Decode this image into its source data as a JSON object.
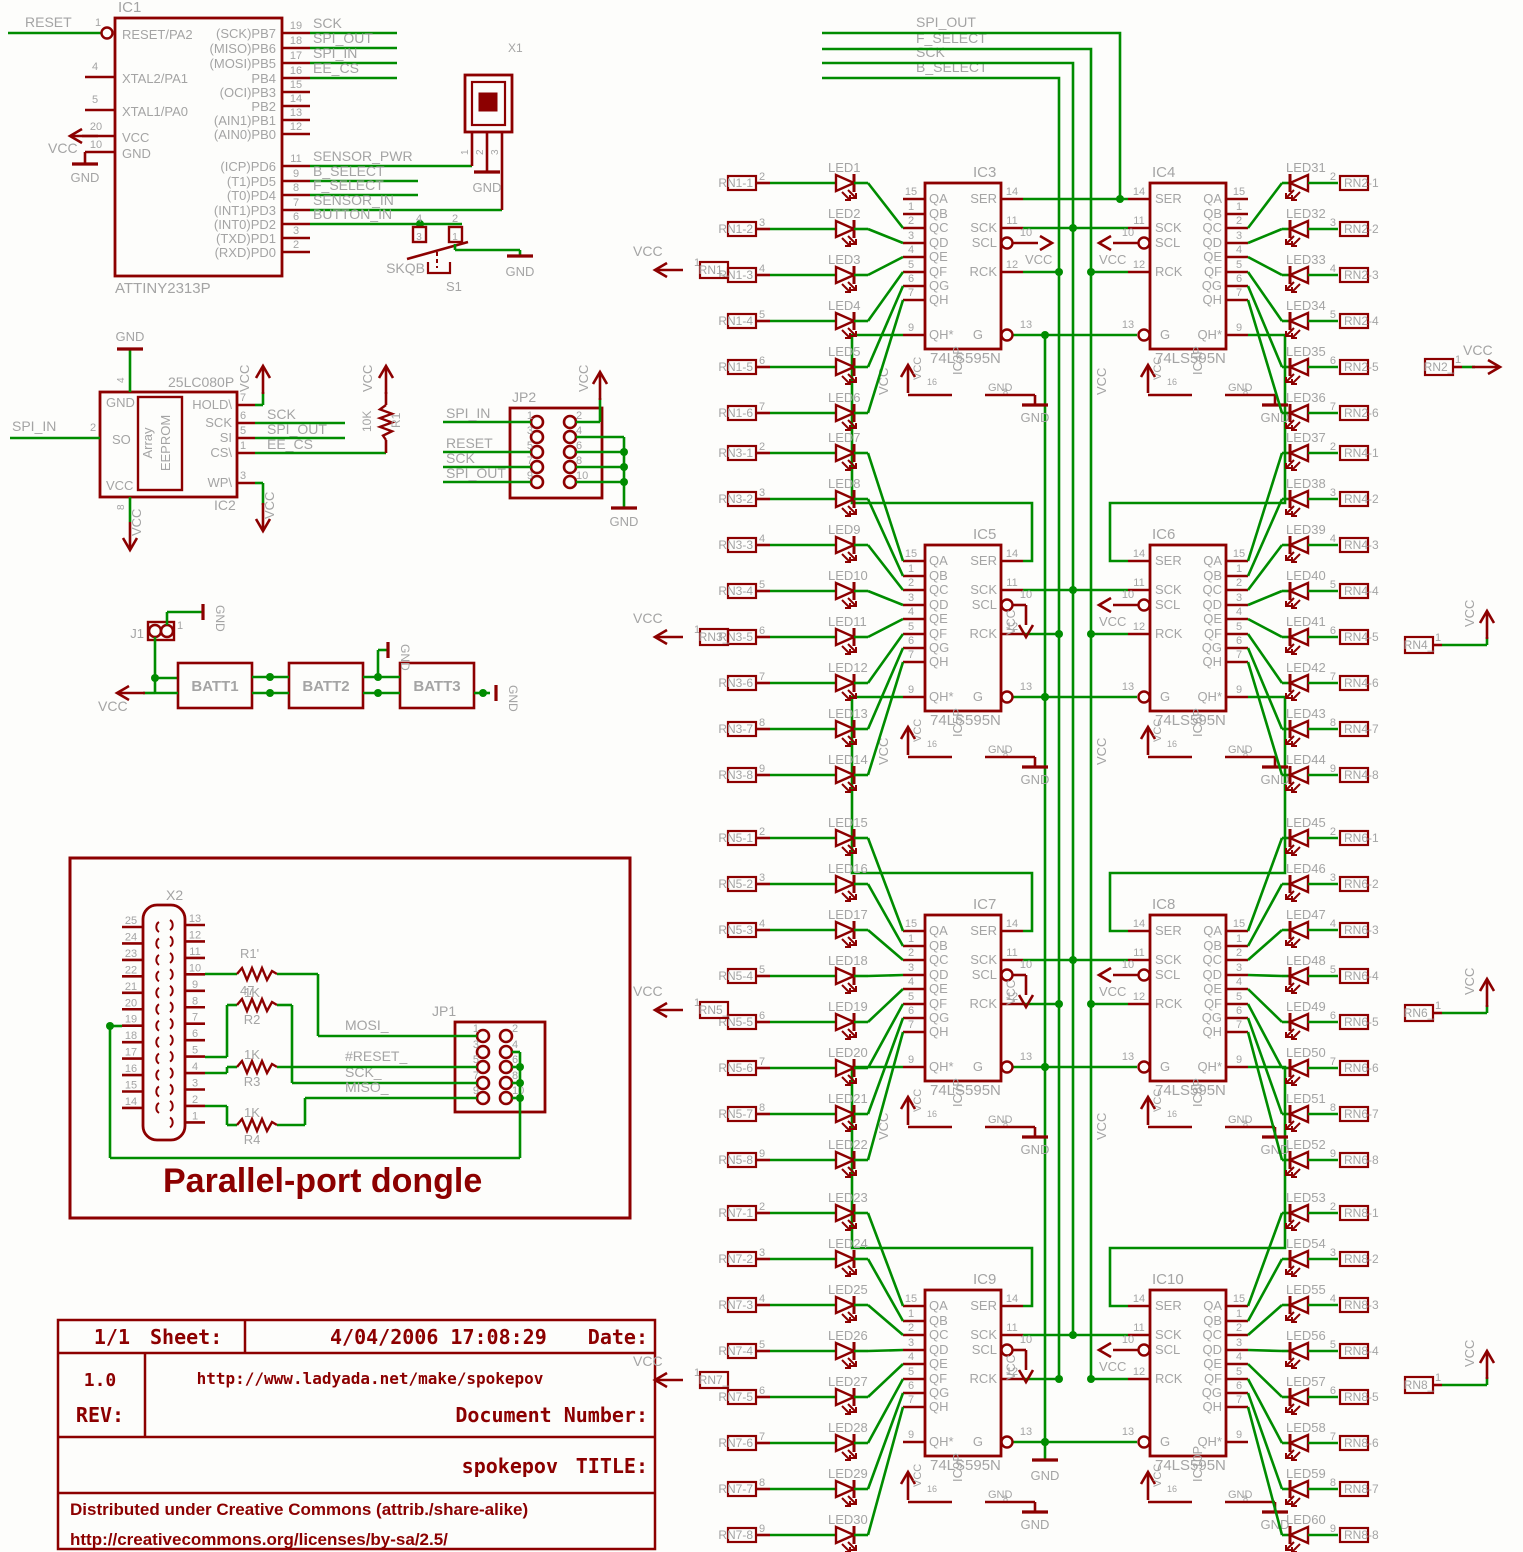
{
  "colors": {
    "wire": "#008C00",
    "part": "#8C0000",
    "label": "#A4A4A4",
    "background": "#FDFDFB"
  },
  "bus": {
    "nets": [
      "SPI_OUT",
      "F_SELECT",
      "SCK",
      "B_SELECT"
    ]
  },
  "power": {
    "vcc": "VCC",
    "gnd": "GND",
    "vcc_pin": "16",
    "gnd_pin": "8"
  },
  "mcu": {
    "ref": "IC1",
    "value": "ATTINY2313P",
    "left_pins": [
      {
        "num": "1",
        "name": "RESET/PA2",
        "net": "RESET"
      },
      {
        "num": "4",
        "name": "XTAL2/PA1"
      },
      {
        "num": "5",
        "name": "XTAL1/PA0"
      },
      {
        "num": "20",
        "name": "VCC"
      },
      {
        "num": "10",
        "name": "GND"
      }
    ],
    "right_pins": [
      {
        "num": "19",
        "name": "(SCK)PB7",
        "net": "SCK"
      },
      {
        "num": "18",
        "name": "(MISO)PB6",
        "net": "SPI_OUT"
      },
      {
        "num": "17",
        "name": "(MOSI)PB5",
        "net": "SPI_IN"
      },
      {
        "num": "16",
        "name": "PB4",
        "net": "EE_CS"
      },
      {
        "num": "15",
        "name": "(OCI)PB3"
      },
      {
        "num": "14",
        "name": "PB2"
      },
      {
        "num": "13",
        "name": "(AIN1)PB1"
      },
      {
        "num": "12",
        "name": "(AIN0)PB0"
      },
      {
        "num": "11",
        "name": "(ICP)PD6",
        "net": "SENSOR_PWR"
      },
      {
        "num": "9",
        "name": "(T1)PD5",
        "net": "B_SELECT"
      },
      {
        "num": "8",
        "name": "(T0)PD4",
        "net": "F_SELECT"
      },
      {
        "num": "7",
        "name": "(INT1)PD3",
        "net": "SENSOR_IN"
      },
      {
        "num": "6",
        "name": "(INT0)PD2",
        "net": "BUTTON_IN"
      },
      {
        "num": "3",
        "name": "(TXD)PD1"
      },
      {
        "num": "2",
        "name": "(RXD)PD0"
      }
    ]
  },
  "sensor": {
    "ref": "X1",
    "pins": [
      "1",
      "2",
      "3"
    ]
  },
  "button": {
    "ref": "S1",
    "value": "SKQB",
    "top_pins": [
      "4",
      "2"
    ],
    "bottom_pins": [
      "3",
      "1"
    ]
  },
  "eeprom": {
    "ref": "IC2",
    "value": "25LC080P",
    "inner1": "Array",
    "inner2": "EEPROM",
    "top_pin": {
      "num": "4",
      "name": "GND"
    },
    "left_pin": {
      "num": "2",
      "name": "SO",
      "net": "SPI_IN"
    },
    "bottom_pin": {
      "num": "8",
      "name": "VCC"
    },
    "right_pins": [
      {
        "num": "7",
        "name": "HOLD\\"
      },
      {
        "num": "6",
        "name": "SCK",
        "net": "SCK"
      },
      {
        "num": "5",
        "name": "SI",
        "net": "SPI_OUT"
      },
      {
        "num": "1",
        "name": "CS\\",
        "net": "EE_CS"
      },
      {
        "num": "3",
        "name": "WP\\"
      }
    ]
  },
  "r1": {
    "ref": "R1",
    "value": "10K"
  },
  "jp2": {
    "ref": "JP2",
    "left_pins": [
      {
        "num": "1",
        "net": "SPI_IN"
      },
      {
        "num": "3"
      },
      {
        "num": "5",
        "net": "RESET"
      },
      {
        "num": "7",
        "net": "SCK"
      },
      {
        "num": "9",
        "net": "SPI_OUT"
      }
    ],
    "right_pins": [
      {
        "num": "2",
        "net": "VCC"
      },
      {
        "num": "4"
      },
      {
        "num": "6"
      },
      {
        "num": "8"
      },
      {
        "num": "10"
      }
    ]
  },
  "battery": {
    "j1_ref": "J1",
    "j1_pin": "1",
    "cells": [
      "BATT1",
      "BATT2",
      "BATT3"
    ]
  },
  "dongle": {
    "title": "Parallel-port dongle",
    "x2_ref": "X2",
    "x2_left_pins": [
      "25",
      "24",
      "23",
      "22",
      "21",
      "20",
      "19",
      "18",
      "17",
      "16",
      "15",
      "14"
    ],
    "x2_right_pins": [
      "13",
      "12",
      "11",
      "10",
      "9",
      "8",
      "7",
      "6",
      "5",
      "4",
      "3",
      "2",
      "1"
    ],
    "resistors": [
      {
        "ref": "R1'",
        "value": "47"
      },
      {
        "ref": "R2",
        "value": "1K"
      },
      {
        "ref": "R3",
        "value": "1K"
      },
      {
        "ref": "R4",
        "value": "1K"
      }
    ],
    "jp1": {
      "ref": "JP1",
      "nets": [
        "MOSI_",
        "#RESET_",
        "SCK_",
        "MISO_"
      ],
      "left_nums": [
        "1",
        "3",
        "5",
        "7",
        "9"
      ],
      "right_nums": [
        "2",
        "4",
        "6",
        "8",
        "10"
      ]
    }
  },
  "titleblock": {
    "sheet_value": "1/1",
    "sheet_label": "Sheet:",
    "date_value": "4/04/2006 17:08:29",
    "date_label": "Date:",
    "rev_value": "1.0",
    "rev_label": "REV:",
    "url": "http://www.ladyada.net/make/spokepov",
    "docnum_label": "Document Number:",
    "title_value": "spokepov",
    "title_label": "TITLE:",
    "cc_line1": "Distributed under Creative Commons (attrib./share-alike)",
    "cc_line2": "http://creativecommons.org/licenses/by-sa/2.5/"
  },
  "register_pins": {
    "outputs": [
      [
        "15",
        "QA"
      ],
      [
        "1",
        "QB"
      ],
      [
        "2",
        "QC"
      ],
      [
        "3",
        "QD"
      ],
      [
        "4",
        "QE"
      ],
      [
        "5",
        "QF"
      ],
      [
        "6",
        "QG"
      ],
      [
        "7",
        "QH"
      ]
    ],
    "qhstar": [
      "9",
      "QH*"
    ],
    "ser": [
      "14",
      "SER"
    ],
    "sck": [
      "11",
      "SCK"
    ],
    "scl": [
      "10",
      "SCL"
    ],
    "rck": [
      "12",
      "RCK"
    ],
    "g": [
      "13",
      "G"
    ]
  },
  "registers": [
    {
      "ref": "IC3",
      "value": "74LS595N",
      "power": "IC3P",
      "side": "left",
      "level": 0
    },
    {
      "ref": "IC4",
      "value": "74LS595N",
      "power": "IC4P",
      "side": "right",
      "level": 0
    },
    {
      "ref": "IC5",
      "value": "74LS595N",
      "power": "IC5P",
      "side": "left",
      "level": 1
    },
    {
      "ref": "IC6",
      "value": "74LS595N",
      "power": "IC6P",
      "side": "right",
      "level": 1
    },
    {
      "ref": "IC7",
      "value": "74LS595N",
      "power": "IC7P",
      "side": "left",
      "level": 2
    },
    {
      "ref": "IC8",
      "value": "74LS595N",
      "power": "IC8P",
      "side": "right",
      "level": 2
    },
    {
      "ref": "IC9",
      "value": "74LS595N",
      "power": "IC9P",
      "side": "left",
      "level": 3
    },
    {
      "ref": "IC10",
      "value": "74LS595N",
      "power": "IC10P",
      "side": "right",
      "level": 3
    }
  ],
  "led_groups": [
    {
      "side": "left",
      "level": 0,
      "common": {
        "ref": "RN1_",
        "pin": "1"
      },
      "rows": [
        {
          "led": "LED1",
          "rn": "RN1-1",
          "pin": "2"
        },
        {
          "led": "LED2",
          "rn": "RN1-2",
          "pin": "3"
        },
        {
          "led": "LED3",
          "rn": "RN1-3",
          "pin": "4"
        },
        {
          "led": "LED4",
          "rn": "RN1-4",
          "pin": "5"
        },
        {
          "led": "LED5",
          "rn": "RN1-5",
          "pin": "6"
        },
        {
          "led": "LED6",
          "rn": "RN1-6",
          "pin": "7"
        }
      ]
    },
    {
      "side": "right",
      "level": 0,
      "common": {
        "ref": "RN2_",
        "pin": "1"
      },
      "rows": [
        {
          "led": "LED31",
          "rn": "RN2-1",
          "pin": "2"
        },
        {
          "led": "LED32",
          "rn": "RN2-2",
          "pin": "3"
        },
        {
          "led": "LED33",
          "rn": "RN2-3",
          "pin": "4"
        },
        {
          "led": "LED34",
          "rn": "RN2-4",
          "pin": "5"
        },
        {
          "led": "LED35",
          "rn": "RN2-5",
          "pin": "6"
        },
        {
          "led": "LED36",
          "rn": "RN2-6",
          "pin": "7"
        }
      ]
    },
    {
      "side": "left",
      "level": 1,
      "common": {
        "ref": "RN3_",
        "pin": "1"
      },
      "rows": [
        {
          "led": "LED7",
          "rn": "RN3-1",
          "pin": "2"
        },
        {
          "led": "LED8",
          "rn": "RN3-2",
          "pin": "3"
        },
        {
          "led": "LED9",
          "rn": "RN3-3",
          "pin": "4"
        },
        {
          "led": "LED10",
          "rn": "RN3-4",
          "pin": "5"
        },
        {
          "led": "LED11",
          "rn": "RN3-5",
          "pin": "6"
        },
        {
          "led": "LED12",
          "rn": "RN3-6",
          "pin": "7"
        },
        {
          "led": "LED13",
          "rn": "RN3-7",
          "pin": "8"
        },
        {
          "led": "LED14",
          "rn": "RN3-8",
          "pin": "9"
        }
      ]
    },
    {
      "side": "right",
      "level": 1,
      "common": {
        "ref": "RN4_",
        "pin": "1"
      },
      "rows": [
        {
          "led": "LED37",
          "rn": "RN4-1",
          "pin": "2"
        },
        {
          "led": "LED38",
          "rn": "RN4-2",
          "pin": "3"
        },
        {
          "led": "LED39",
          "rn": "RN4-3",
          "pin": "4"
        },
        {
          "led": "LED40",
          "rn": "RN4-4",
          "pin": "5"
        },
        {
          "led": "LED41",
          "rn": "RN4-5",
          "pin": "6"
        },
        {
          "led": "LED42",
          "rn": "RN4-6",
          "pin": "7"
        },
        {
          "led": "LED43",
          "rn": "RN4-7",
          "pin": "8"
        },
        {
          "led": "LED44",
          "rn": "RN4-8",
          "pin": "9"
        }
      ]
    },
    {
      "side": "left",
      "level": 2,
      "common": {
        "ref": "RN5_",
        "pin": "1"
      },
      "rows": [
        {
          "led": "LED15",
          "rn": "RN5-1",
          "pin": "2"
        },
        {
          "led": "LED16",
          "rn": "RN5-2",
          "pin": "3"
        },
        {
          "led": "LED17",
          "rn": "RN5-3",
          "pin": "4"
        },
        {
          "led": "LED18",
          "rn": "RN5-4",
          "pin": "5"
        },
        {
          "led": "LED19",
          "rn": "RN5-5",
          "pin": "6"
        },
        {
          "led": "LED20",
          "rn": "RN5-6",
          "pin": "7"
        },
        {
          "led": "LED21",
          "rn": "RN5-7",
          "pin": "8"
        },
        {
          "led": "LED22",
          "rn": "RN5-8",
          "pin": "9"
        }
      ]
    },
    {
      "side": "right",
      "level": 2,
      "common": {
        "ref": "RN6_",
        "pin": "1"
      },
      "rows": [
        {
          "led": "LED45",
          "rn": "RN6-1",
          "pin": "2"
        },
        {
          "led": "LED46",
          "rn": "RN6-2",
          "pin": "3"
        },
        {
          "led": "LED47",
          "rn": "RN6-3",
          "pin": "4"
        },
        {
          "led": "LED48",
          "rn": "RN6-4",
          "pin": "5"
        },
        {
          "led": "LED49",
          "rn": "RN6-5",
          "pin": "6"
        },
        {
          "led": "LED50",
          "rn": "RN6-6",
          "pin": "7"
        },
        {
          "led": "LED51",
          "rn": "RN6-7",
          "pin": "8"
        },
        {
          "led": "LED52",
          "rn": "RN6-8",
          "pin": "9"
        }
      ]
    },
    {
      "side": "left",
      "level": 3,
      "common": {
        "ref": "RN7_",
        "pin": "1"
      },
      "rows": [
        {
          "led": "LED23",
          "rn": "RN7-1",
          "pin": "2"
        },
        {
          "led": "LED24",
          "rn": "RN7-2",
          "pin": "3"
        },
        {
          "led": "LED25",
          "rn": "RN7-3",
          "pin": "4"
        },
        {
          "led": "LED26",
          "rn": "RN7-4",
          "pin": "5"
        },
        {
          "led": "LED27",
          "rn": "RN7-5",
          "pin": "6"
        },
        {
          "led": "LED28",
          "rn": "RN7-6",
          "pin": "7"
        },
        {
          "led": "LED29",
          "rn": "RN7-7",
          "pin": "8"
        },
        {
          "led": "LED30",
          "rn": "RN7-8",
          "pin": "9"
        }
      ]
    },
    {
      "side": "right",
      "level": 3,
      "common": {
        "ref": "RN8_",
        "pin": "1"
      },
      "rows": [
        {
          "led": "LED53",
          "rn": "RN8-1",
          "pin": "2"
        },
        {
          "led": "LED54",
          "rn": "RN8-2",
          "pin": "3"
        },
        {
          "led": "LED55",
          "rn": "RN8-3",
          "pin": "4"
        },
        {
          "led": "LED56",
          "rn": "RN8-4",
          "pin": "5"
        },
        {
          "led": "LED57",
          "rn": "RN8-5",
          "pin": "6"
        },
        {
          "led": "LED58",
          "rn": "RN8-6",
          "pin": "7"
        },
        {
          "led": "LED59",
          "rn": "RN8-7",
          "pin": "8"
        },
        {
          "led": "LED60",
          "rn": "RN8-8",
          "pin": "9"
        }
      ]
    }
  ]
}
